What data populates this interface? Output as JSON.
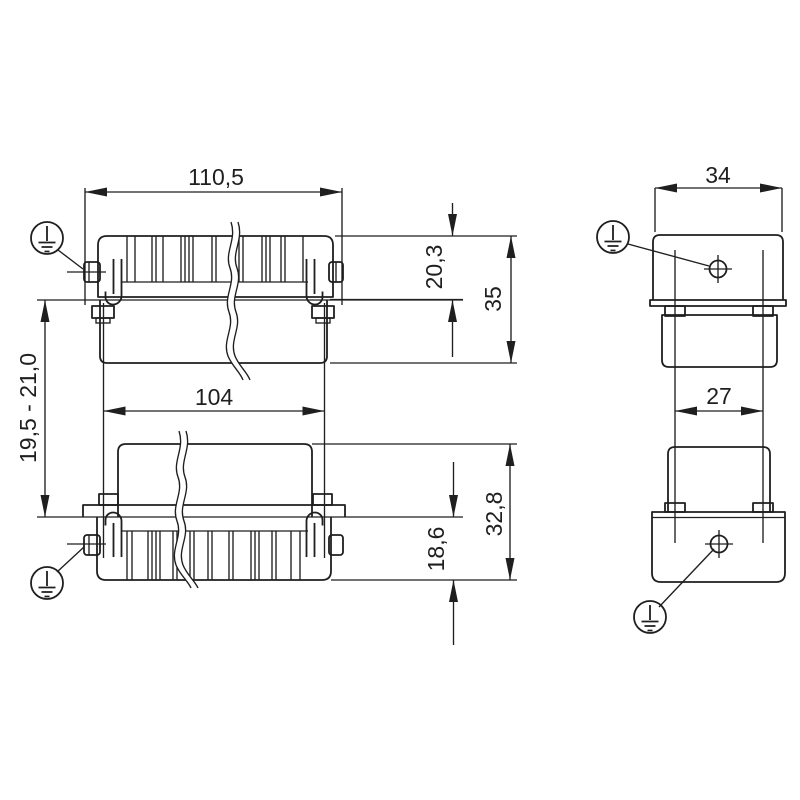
{
  "page": {
    "background": "#ffffff",
    "line_color": "#1f1f1f"
  },
  "front_view": {
    "dim_overall_width": "110,5",
    "dim_insert_width": "104",
    "dim_hood_height": "20,3",
    "dim_top_total_height": "35",
    "dim_panel_thickness": "19,5 - 21,0",
    "dim_bottom_total_height": "32,8",
    "dim_bottom_height": "18,6"
  },
  "side_view": {
    "dim_overall_width": "34",
    "dim_collar_width": "27"
  },
  "icons": {
    "protective_earth": "pe-ground-symbol",
    "screw_position": "crosshair-marker"
  }
}
